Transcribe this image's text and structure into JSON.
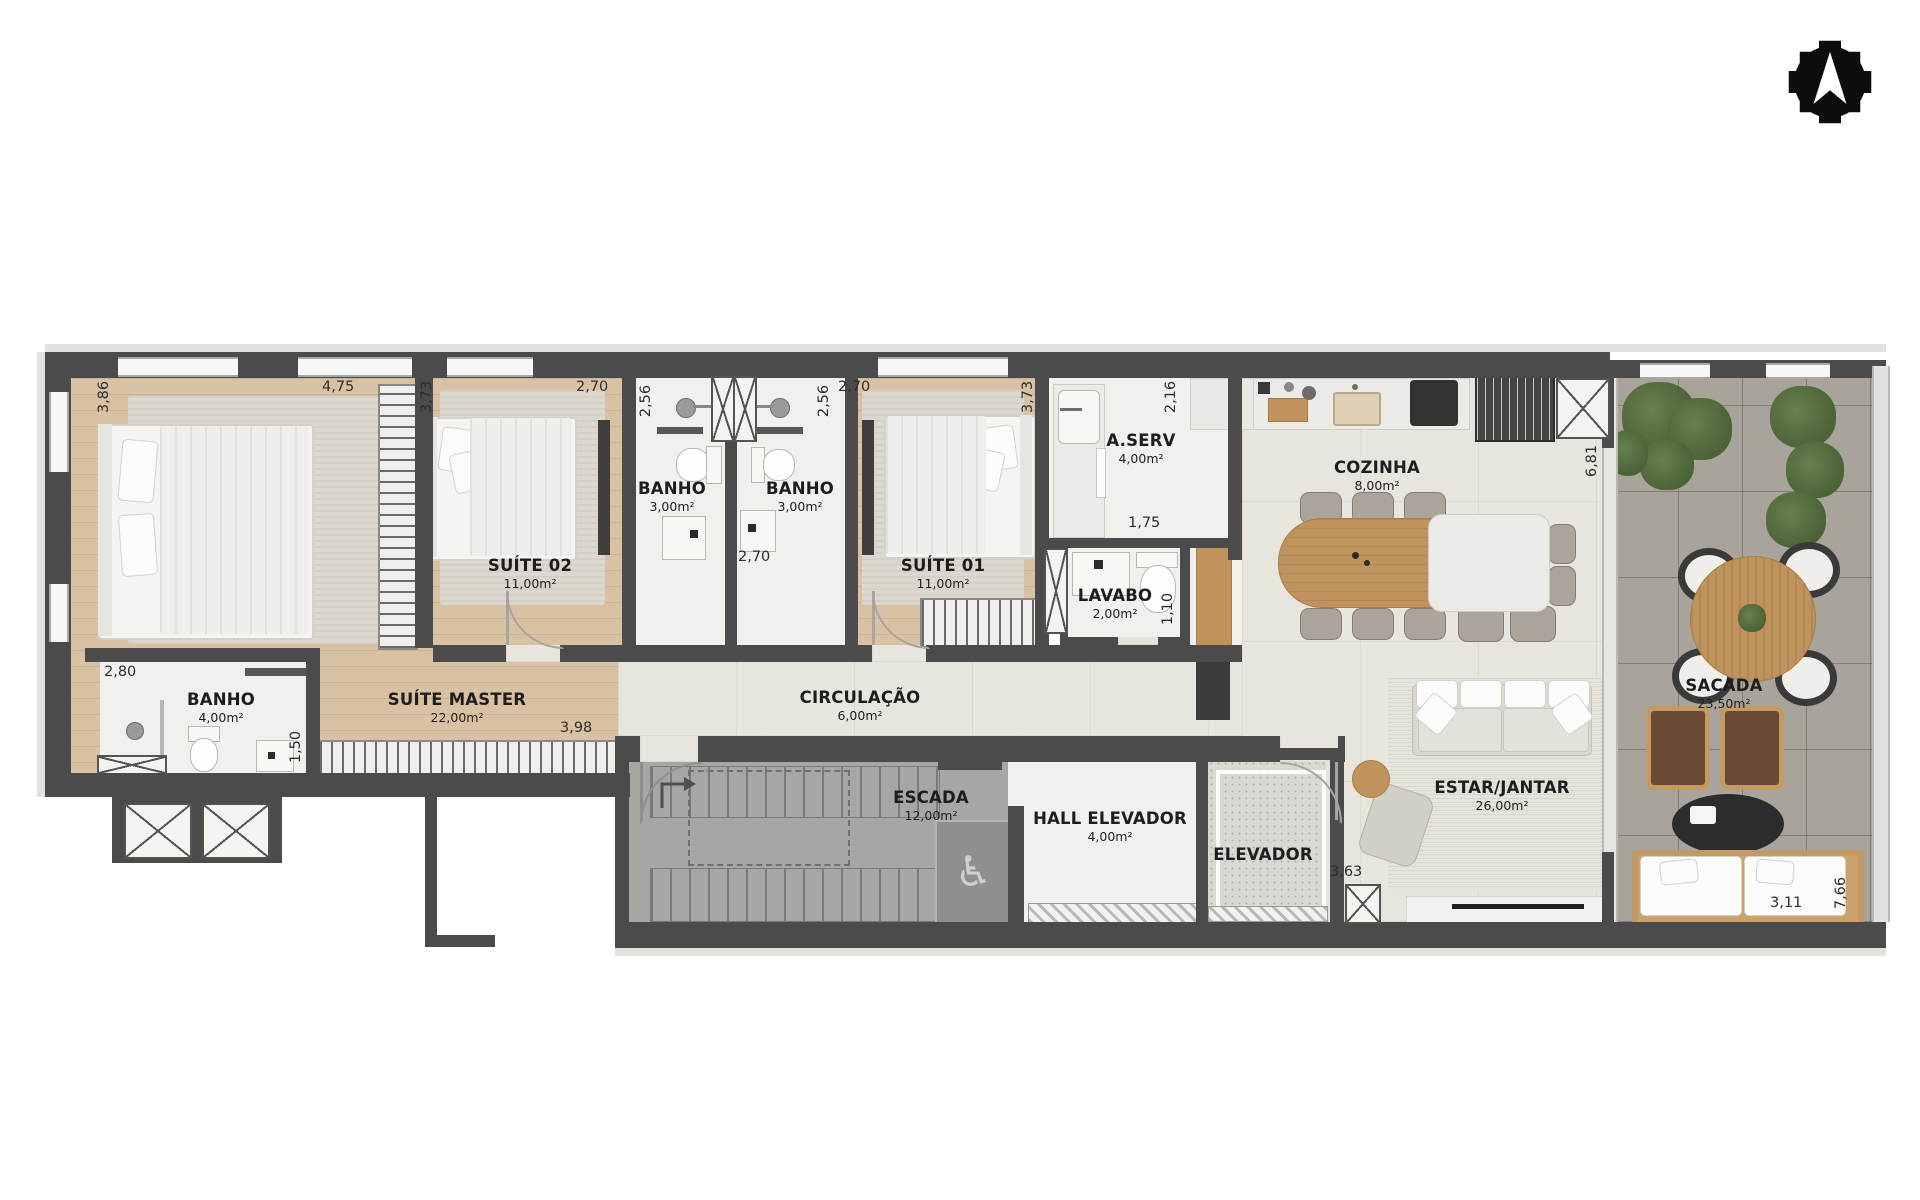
{
  "palette": {
    "wall": "#4c4b4b",
    "wood_floor": "#d9c2a4",
    "tile": "#f1f0ed",
    "kitchen_floor": "#e8e5de",
    "balcony_floor": "#a9a49b",
    "stairs_floor": "#a6a6a3",
    "wood_furniture": "#c0935c",
    "marble": "#eceae6",
    "plant_green": "#5c7344",
    "logo_black": "#0d0d0d",
    "background": "#ffffff"
  },
  "icons": {
    "wheelchair": "♿"
  },
  "rooms": {
    "suite_master": {
      "name": "SUÍTE MASTER",
      "area": "22,00m²"
    },
    "suite_02": {
      "name": "SUÍTE 02",
      "area": "11,00m²"
    },
    "suite_01": {
      "name": "SUÍTE 01",
      "area": "11,00m²"
    },
    "banho_suite_02": {
      "name": "BANHO",
      "area": "3,00m²"
    },
    "banho_suite_01": {
      "name": "BANHO",
      "area": "3,00m²"
    },
    "banho_master": {
      "name": "BANHO",
      "area": "4,00m²"
    },
    "a_serv": {
      "name": "A.SERV",
      "area": "4,00m²"
    },
    "lavabo": {
      "name": "LAVABO",
      "area": "2,00m²"
    },
    "cozinha": {
      "name": "COZINHA",
      "area": "8,00m²"
    },
    "circulacao": {
      "name": "CIRCULAÇÃO",
      "area": "6,00m²"
    },
    "escada": {
      "name": "ESCADA",
      "area": "12,00m²"
    },
    "hall_elevador": {
      "name": "HALL ELEVADOR",
      "area": "4,00m²"
    },
    "elevador": {
      "name": "ELEVADOR"
    },
    "estar_jantar": {
      "name": "ESTAR/JANTAR",
      "area": "26,00m²"
    },
    "sacada": {
      "name": "SACADA",
      "area": "23,50m²"
    }
  },
  "dims": {
    "d386": "3,86",
    "d475": "4,75",
    "d373a": "3,73",
    "d270a": "2,70",
    "d256a": "2,56",
    "d256b": "2,56",
    "d270b": "2,70",
    "d373b": "3,73",
    "d216": "2,16",
    "d175": "1,75",
    "d110": "1,10",
    "d681": "6,81",
    "d280": "2,80",
    "d150": "1,50",
    "d398": "3,98",
    "d270c": "2,70",
    "d363": "3,63",
    "d311": "3,11",
    "d766": "7,66"
  }
}
